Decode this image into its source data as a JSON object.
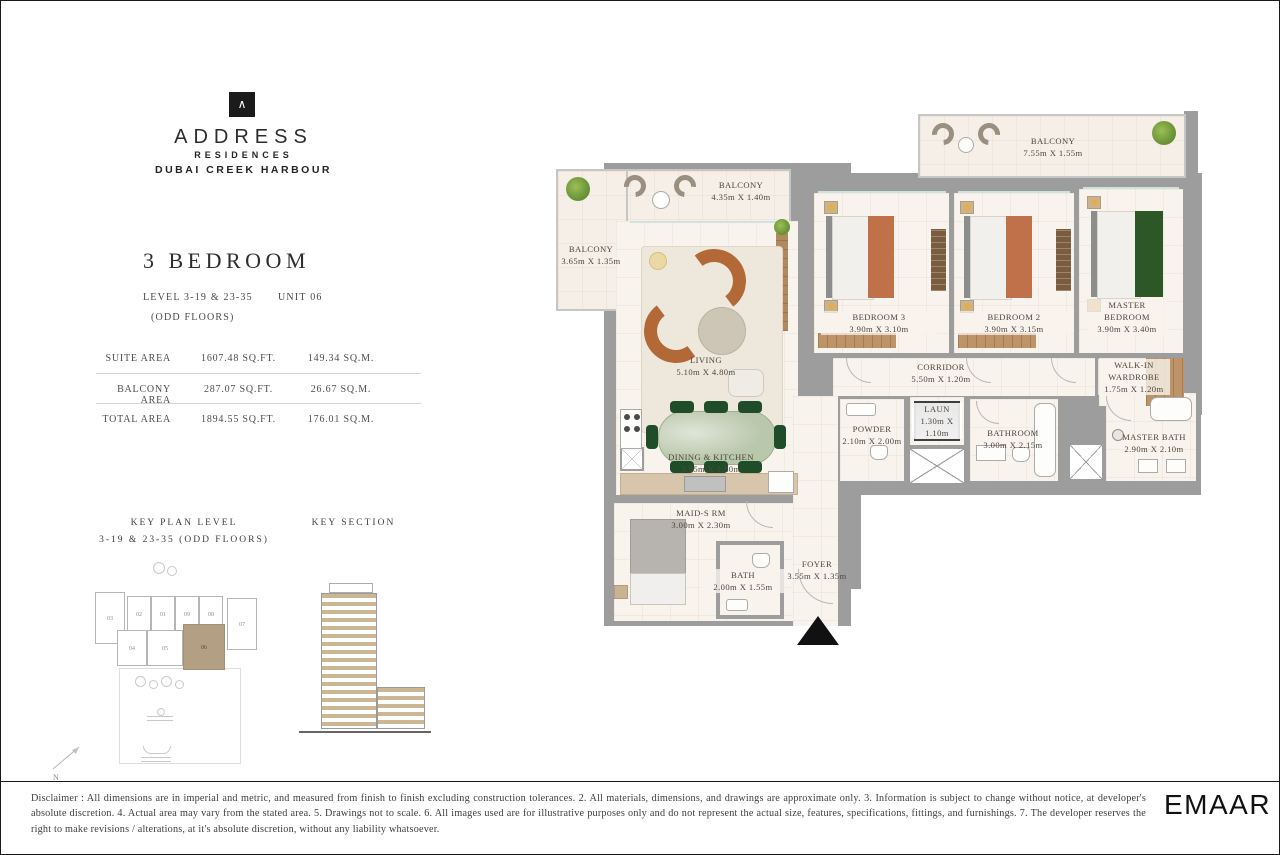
{
  "brand": {
    "mark": "∧",
    "name": "ADDRESS",
    "line1": "RESIDENCES",
    "line2": "DUBAI CREEK HARBOUR"
  },
  "unit_info": {
    "title": "3 BEDROOM",
    "level": "LEVEL 3-19 & 23-35",
    "unit": "UNIT 06",
    "floors_note": "(ODD FLOORS)"
  },
  "areas": {
    "rows": [
      {
        "label": "SUITE AREA",
        "imperial": "1607.48 SQ.FT.",
        "metric": "149.34 SQ.M."
      },
      {
        "label": "BALCONY AREA",
        "imperial": "287.07 SQ.FT.",
        "metric": "26.67 SQ.M."
      },
      {
        "label": "TOTAL AREA",
        "imperial": "1894.55 SQ.FT.",
        "metric": "176.01 SQ.M."
      }
    ]
  },
  "key_plan": {
    "title": "KEY PLAN LEVEL",
    "subtitle": "3-19 & 23-35 (ODD FLOORS)",
    "units_top": [
      "03",
      "02",
      "01",
      "09",
      "08",
      "07"
    ],
    "units_bottom": [
      "04",
      "05",
      "06"
    ],
    "highlighted_unit": "06"
  },
  "key_section": {
    "title": "KEY SECTION"
  },
  "compass": {
    "label": "N"
  },
  "rooms": {
    "balcony_top": {
      "label": "BALCONY",
      "dims": "4.35m X 1.40m"
    },
    "balcony_left": {
      "label": "BALCONY",
      "dims": "3.65m X 1.35m"
    },
    "balcony_right": {
      "label": "BALCONY",
      "dims": "7.55m X 1.55m"
    },
    "living": {
      "label": "LIVING",
      "dims": "5.10m X 4.80m"
    },
    "bedroom3": {
      "label": "BEDROOM 3",
      "dims": "3.90m X 3.10m"
    },
    "bedroom2": {
      "label": "BEDROOM 2",
      "dims": "3.90m X 3.15m"
    },
    "master_bedroom": {
      "label": "MASTER BEDROOM",
      "dims": "3.90m X 3.40m"
    },
    "corridor": {
      "label": "CORRIDOR",
      "dims": "5.50m X 1.20m"
    },
    "walk_in_wardrobe": {
      "label": "WALK-IN WARDROBE",
      "dims": "1.75m X 1.20m"
    },
    "powder": {
      "label": "POWDER",
      "dims": "2.10m X 2.00m"
    },
    "laundry": {
      "label": "LAUN",
      "dims": "1.30m X 1.10m"
    },
    "bathroom": {
      "label": "BATHROOM",
      "dims": "3.00m X 2.15m"
    },
    "master_bath": {
      "label": "MASTER BATH",
      "dims": "2.90m X 2.10m"
    },
    "dining_kitchen": {
      "label": "DINING & KITCHEN",
      "dims": "3.95m X 1.80m"
    },
    "maids_room": {
      "label": "MAID-S RM",
      "dims": "3.00m X 2.30m"
    },
    "bath": {
      "label": "BATH",
      "dims": "2.00m X 1.55m"
    },
    "foyer": {
      "label": "FOYER",
      "dims": "3.55m X 1.35m"
    }
  },
  "footer": {
    "disclaimer": "Disclaimer : All dimensions are in imperial and metric, and measured from finish to finish excluding construction tolerances. 2. All materials, dimensions, and drawings are approximate only. 3. Information is subject to change without notice, at developer's absolute discretion. 4. Actual area may vary from the stated area. 5. Drawings not to scale. 6. All images used are for illustrative purposes only and do not represent the actual size, features, specifications, fittings, and furnishings. 7. The developer reserves the right to make revisions / alterations, at it's absolute discretion, without any liability whatsoever.",
    "logo": "EMAAR"
  },
  "colors": {
    "wall": "#9d9d9d",
    "floor": "#f8f3ec",
    "balcony_floor": "#f6efe8",
    "accent_tan": "#b3a084",
    "sofa_brown": "#b26837",
    "dining_table_green": "#b9c7ab",
    "chair_green": "#1f4d2a",
    "bed_throw_orange": "#c0714a",
    "bed_throw_green": "#2e5727",
    "wood": "#bd9468"
  }
}
